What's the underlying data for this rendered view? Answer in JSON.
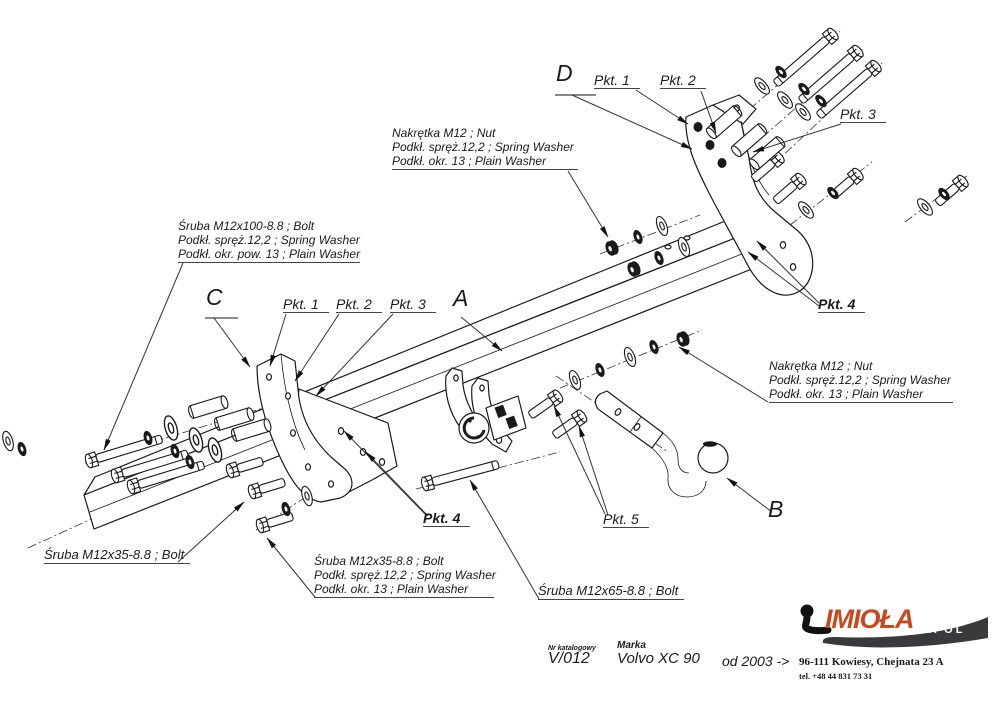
{
  "drawing": {
    "part_labels": {
      "a": "A",
      "b": "B",
      "c": "C",
      "d": "D"
    },
    "point_labels": {
      "pkt1": "Pkt. 1",
      "pkt2": "Pkt. 2",
      "pkt3": "Pkt. 3",
      "pkt4": "Pkt. 4",
      "pkt5": "Pkt. 5"
    },
    "callouts": {
      "nut_top": {
        "lines": [
          "Nakrętka  M12 ; Nut",
          "Podkł. spręż.12,2 ; Spring Washer",
          "Podkł. okr. 13 ; Plain Washer"
        ]
      },
      "bolt_m12x100": {
        "lines": [
          "Śruba M12x100-8.8 ;  Bolt",
          "Podkł. spręż.12,2 ; Spring Washer",
          "Podkł. okr. pow. 13 ; Plain Washer"
        ]
      },
      "nut_right": {
        "lines": [
          "Nakrętka  M12 ; Nut",
          "Podkł. spręż.12,2 ; Spring Washer",
          "Podkł. okr. 13 ; Plain Washer"
        ]
      },
      "bolt_m12x35_left": {
        "text": "Śruba M12x35-8.8 ;  Bolt"
      },
      "bolt_m12x35_block": {
        "lines": [
          "Śruba M12x35-8.8 ;  Bolt",
          "Podkł. spręż.12,2 ; Spring Washer",
          "Podkł. okr. 13 ; Plain Washer"
        ]
      },
      "bolt_m12x65": {
        "text": "Śruba M12x65-8.8 ;  Bolt"
      }
    }
  },
  "title_block": {
    "catalog_label": "Nr katalogowy",
    "catalog_value": "V/012",
    "brand_label": "Marka",
    "brand_value": "Volvo XC 90",
    "year_range": "od  2003 ->"
  },
  "footer": {
    "logo_main": "IMIOŁA",
    "logo_sub": "HAKPOL",
    "address": "96-111 Kowiesy,  Chejnata 23 A",
    "phone": "tel. +48 44 831 73 31",
    "colors": {
      "logo_orange": "#c9481d",
      "logo_gray": "#3a3a3c",
      "line": "#1a1a1a",
      "leader": "#333333"
    }
  }
}
